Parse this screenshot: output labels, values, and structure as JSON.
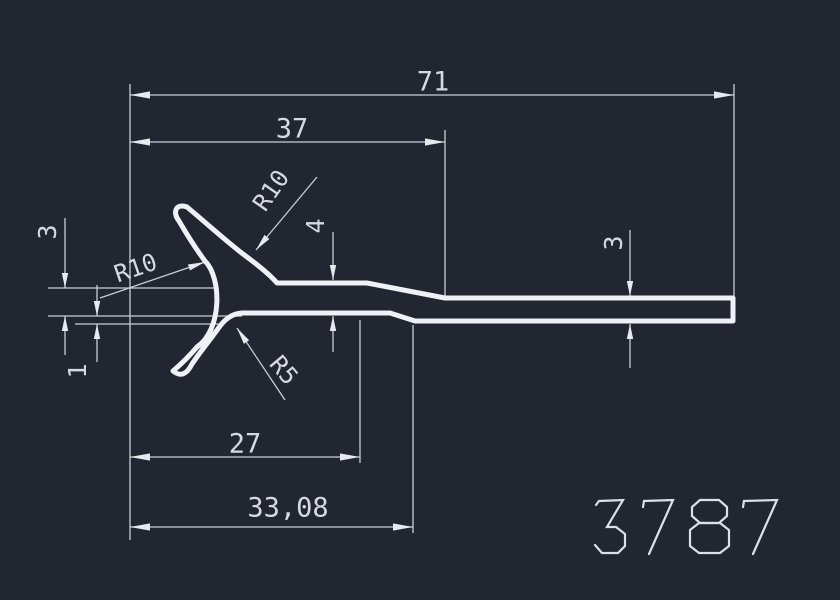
{
  "part_number": "3787",
  "drawing_type": "extrusion-profile-cross-section",
  "colors": {
    "background": "#212630",
    "profile_stroke": "#eef1f5",
    "dimension_lines": "#c9ced6",
    "text": "#d6dae0",
    "part_number": "#dde1e6"
  },
  "dimensions_shown": {
    "overall_length": "71",
    "intermediate_length": "37",
    "clip_length": "27",
    "clip_length_total": "33,08",
    "left_thickness": "4",
    "right_thickness": "3",
    "left_gap": "3",
    "bottom_step": "1",
    "radius_upper": "R10",
    "radius_left": "R10",
    "radius_lower": "R5"
  },
  "drawing": {
    "profile_path": "M277,283 L367,283 L445,298 L733,298 L733,321 L415,321 L390,313 L243,313 Q230,313 220,326 C210,340 200,352 192,364 Q184,380 173,371 Q186,360 197,347 C222,330 222,278 205,261 Q193,245 179,221 C172,212 176,203 187,207 C205,222 226,241 243,254 C262,268 271,276 277,283 Z",
    "ext_lines": [
      [
        130,
        84,
        130,
        540
      ],
      [
        734,
        84,
        734,
        298
      ],
      [
        445,
        130,
        445,
        296
      ],
      [
        360,
        320,
        360,
        463
      ],
      [
        413,
        325,
        413,
        533
      ],
      [
        48,
        288,
        215,
        288
      ],
      [
        48,
        316,
        242,
        316
      ],
      [
        75,
        324,
        222,
        324
      ]
    ],
    "dim_lines": [
      [
        130,
        95,
        734,
        95
      ],
      [
        130,
        142,
        445,
        142
      ],
      [
        130,
        457,
        360,
        457
      ],
      [
        130,
        527,
        413,
        527
      ],
      [
        333,
        232,
        333,
        280
      ],
      [
        333,
        316,
        333,
        352
      ],
      [
        630,
        230,
        630,
        296
      ],
      [
        630,
        324,
        630,
        368
      ],
      [
        65,
        218,
        65,
        288
      ],
      [
        65,
        316,
        65,
        355
      ],
      [
        97,
        285,
        97,
        316
      ],
      [
        97,
        324,
        97,
        362
      ]
    ],
    "leader_lines": [
      [
        100,
        298,
        205,
        262
      ],
      [
        317,
        177,
        256,
        250
      ],
      [
        237,
        328,
        285,
        400
      ]
    ],
    "arrows": [
      {
        "x": 130,
        "y": 95,
        "a": 180,
        "l": 20,
        "w": 3.6
      },
      {
        "x": 734,
        "y": 95,
        "a": 0,
        "l": 20,
        "w": 3.6
      },
      {
        "x": 130,
        "y": 142,
        "a": 180,
        "l": 20,
        "w": 3.6
      },
      {
        "x": 445,
        "y": 142,
        "a": 0,
        "l": 20,
        "w": 3.6
      },
      {
        "x": 130,
        "y": 457,
        "a": 180,
        "l": 20,
        "w": 3.6
      },
      {
        "x": 360,
        "y": 457,
        "a": 0,
        "l": 20,
        "w": 3.6
      },
      {
        "x": 130,
        "y": 527,
        "a": 180,
        "l": 20,
        "w": 3.6
      },
      {
        "x": 413,
        "y": 527,
        "a": 0,
        "l": 20,
        "w": 3.6
      },
      {
        "x": 333,
        "y": 280,
        "a": 90,
        "l": 15,
        "w": 3.2
      },
      {
        "x": 333,
        "y": 316,
        "a": -90,
        "l": 15,
        "w": 3.2
      },
      {
        "x": 630,
        "y": 296,
        "a": 90,
        "l": 15,
        "w": 3.2
      },
      {
        "x": 630,
        "y": 324,
        "a": -90,
        "l": 15,
        "w": 3.2
      },
      {
        "x": 65,
        "y": 288,
        "a": 90,
        "l": 15,
        "w": 3.2
      },
      {
        "x": 65,
        "y": 316,
        "a": -90,
        "l": 15,
        "w": 3.2
      },
      {
        "x": 97,
        "y": 316,
        "a": 90,
        "l": 15,
        "w": 3.2
      },
      {
        "x": 97,
        "y": 324,
        "a": -90,
        "l": 15,
        "w": 3.2
      },
      {
        "x": 205,
        "y": 262,
        "a": -19,
        "l": 17,
        "w": 3.2
      },
      {
        "x": 256,
        "y": 250,
        "a": 130,
        "l": 17,
        "w": 3.2
      },
      {
        "x": 237,
        "y": 328,
        "a": -124,
        "l": 17,
        "w": 3.2
      }
    ],
    "labels": [
      {
        "text": "71",
        "x": 433,
        "y": 83,
        "rot": 0,
        "size": 27,
        "name": "dim-label-71"
      },
      {
        "text": "37",
        "x": 292,
        "y": 130,
        "rot": 0,
        "size": 27,
        "name": "dim-label-37"
      },
      {
        "text": "27",
        "x": 245,
        "y": 445,
        "rot": 0,
        "size": 27,
        "name": "dim-label-27"
      },
      {
        "text": "33,08",
        "x": 288,
        "y": 509,
        "rot": 0,
        "size": 27,
        "name": "dim-label-33-08"
      },
      {
        "text": "4",
        "x": 317,
        "y": 226,
        "rot": -90,
        "size": 25,
        "name": "dim-label-4"
      },
      {
        "text": "3",
        "x": 615,
        "y": 243,
        "rot": -90,
        "size": 25,
        "name": "dim-label-3-right"
      },
      {
        "text": "3",
        "x": 49,
        "y": 232,
        "rot": -90,
        "size": 25,
        "name": "dim-label-3-left"
      },
      {
        "text": "1",
        "x": 79,
        "y": 371,
        "rot": -90,
        "size": 25,
        "name": "dim-label-1"
      },
      {
        "text": "R10",
        "x": 272,
        "y": 191,
        "rot": -55,
        "size": 24,
        "name": "radius-label-r10-upper"
      },
      {
        "text": "R10",
        "x": 136,
        "y": 269,
        "rot": -19,
        "size": 24,
        "name": "radius-label-r10-left"
      },
      {
        "text": "R5",
        "x": 283,
        "y": 371,
        "rot": 50,
        "size": 24,
        "name": "radius-label-r5"
      }
    ],
    "part_number_glyphs": [
      "M596,505 L599,501 L623,500 L607,527 L616,527 L625,534 L625,546 L618,553 L602,553 L595,545",
      "M643,507 L644,501 L673,500 L649,554",
      "M700,500 L719,500 L727,507 L727,516 L719,523 L700,523 L692,516 L692,507 Z",
      "M699,523 L720,523 L729,530 L729,546 L720,553 L699,553 L690,546 L690,530 Z",
      "M743,507 L744,501 L777,500 L753,554"
    ]
  }
}
